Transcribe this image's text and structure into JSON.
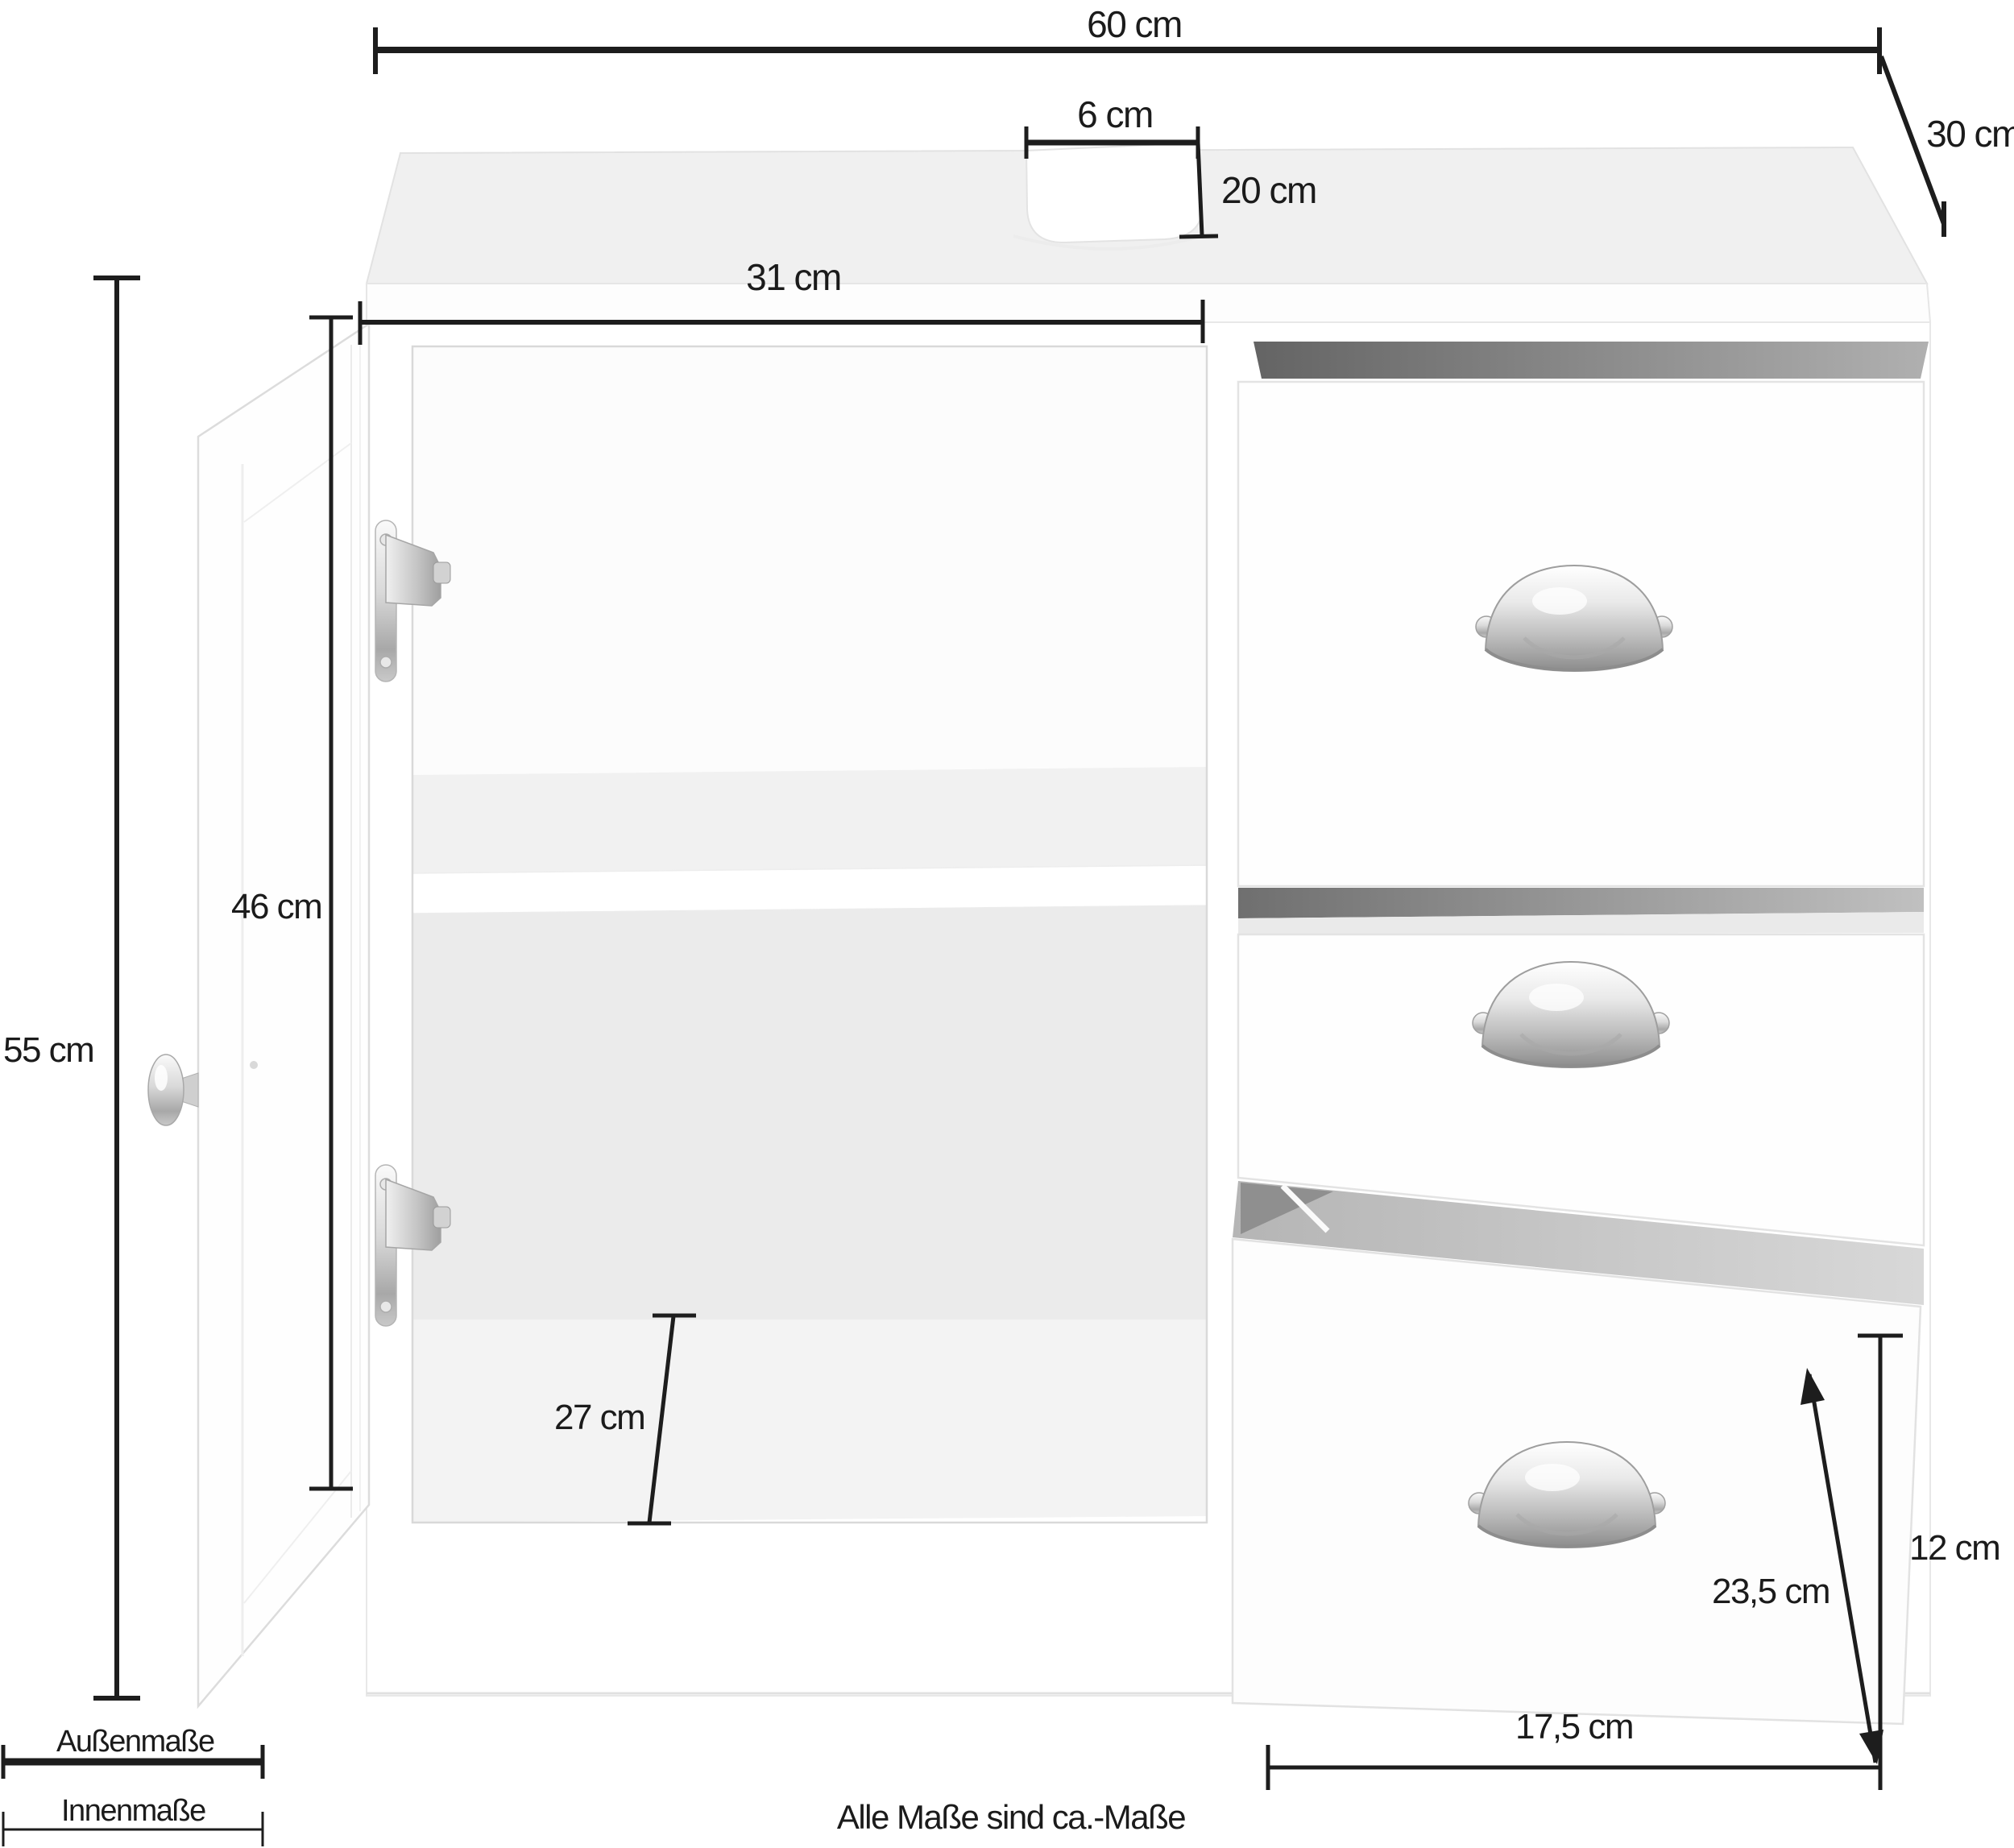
{
  "dimensions": {
    "total_width": "60 cm",
    "total_depth": "30 cm",
    "pipe_cutout_width": "6 cm",
    "pipe_cutout_depth": "20 cm",
    "left_inner_width": "31 cm",
    "total_height": "55 cm",
    "door_inner_height": "46 cm",
    "inner_depth": "27 cm",
    "drawer_front_height": "12 cm",
    "drawer_depth": "23,5 cm",
    "drawer_inner_width": "17,5 cm"
  },
  "legend": {
    "outer": "Außenmaße",
    "inner": "Innenmaße"
  },
  "footnote": "Alle Maße sind ca.-Maße",
  "colors": {
    "dimension_line": "#1d1d1d",
    "text": "#1b1b1b",
    "cabinet_surface": "#f0f0f0",
    "cabinet_front": "#fefefe",
    "interior_wall": "#ebebeb",
    "gap_shadow": "#6d6d6d",
    "metal": "#c6c6c6",
    "background": "#ffffff"
  }
}
